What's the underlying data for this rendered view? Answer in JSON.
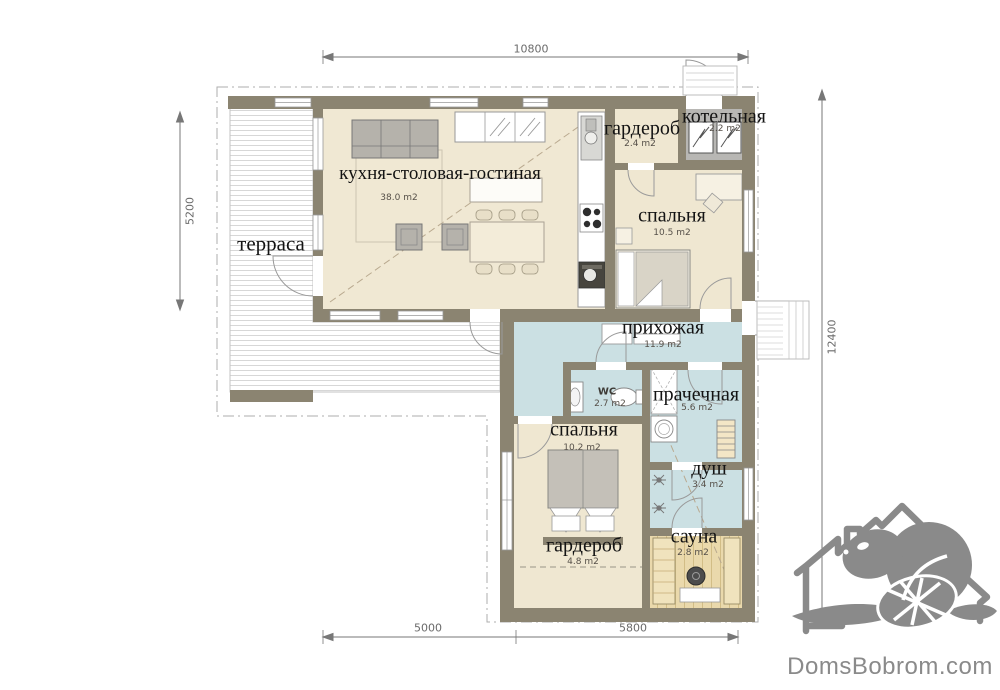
{
  "watermark": {
    "site": "DomsBobrom.com",
    "logo_icon": "house-with-beaver",
    "color": "#8a8a8a"
  },
  "rooms": [
    {
      "id": "terrace",
      "name": "терраса",
      "area": ""
    },
    {
      "id": "kitchen-living",
      "name": "кухня-столовая-гостиная",
      "area": "38.0 m2"
    },
    {
      "id": "wardrobe-top",
      "name": "гардероб",
      "area": "2.4 m2"
    },
    {
      "id": "boiler",
      "name": "котельная",
      "area": "2.2 m2"
    },
    {
      "id": "bedroom-1",
      "name": "спальня",
      "area": "10.5 m2"
    },
    {
      "id": "hallway",
      "name": "прихожая",
      "area": "11.9 m2"
    },
    {
      "id": "wc",
      "name": "WC",
      "area": "2.7 m2"
    },
    {
      "id": "laundry",
      "name": "прачечная",
      "area": "5.6 m2"
    },
    {
      "id": "bedroom-2",
      "name": "спальня",
      "area": "10.2 m2"
    },
    {
      "id": "shower",
      "name": "душ",
      "area": "3.4 m2"
    },
    {
      "id": "sauna",
      "name": "сауна",
      "area": "2.8 m2"
    },
    {
      "id": "wardrobe-bottom",
      "name": "гардероб",
      "area": "4.8 m2"
    }
  ],
  "dimensions": {
    "top": "10800",
    "left": "5200",
    "right": "12400",
    "bottom_left": "5000",
    "bottom_right": "5800"
  },
  "colors": {
    "wall": "#8b8471",
    "floor_cream": "#f0e8d3",
    "floor_blue": "#cbe0e3",
    "floor_wood": "#ead9ac",
    "floor_boiler": "#b8b7b4",
    "dimension": "#777777",
    "watermark": "#8a8a8a"
  }
}
